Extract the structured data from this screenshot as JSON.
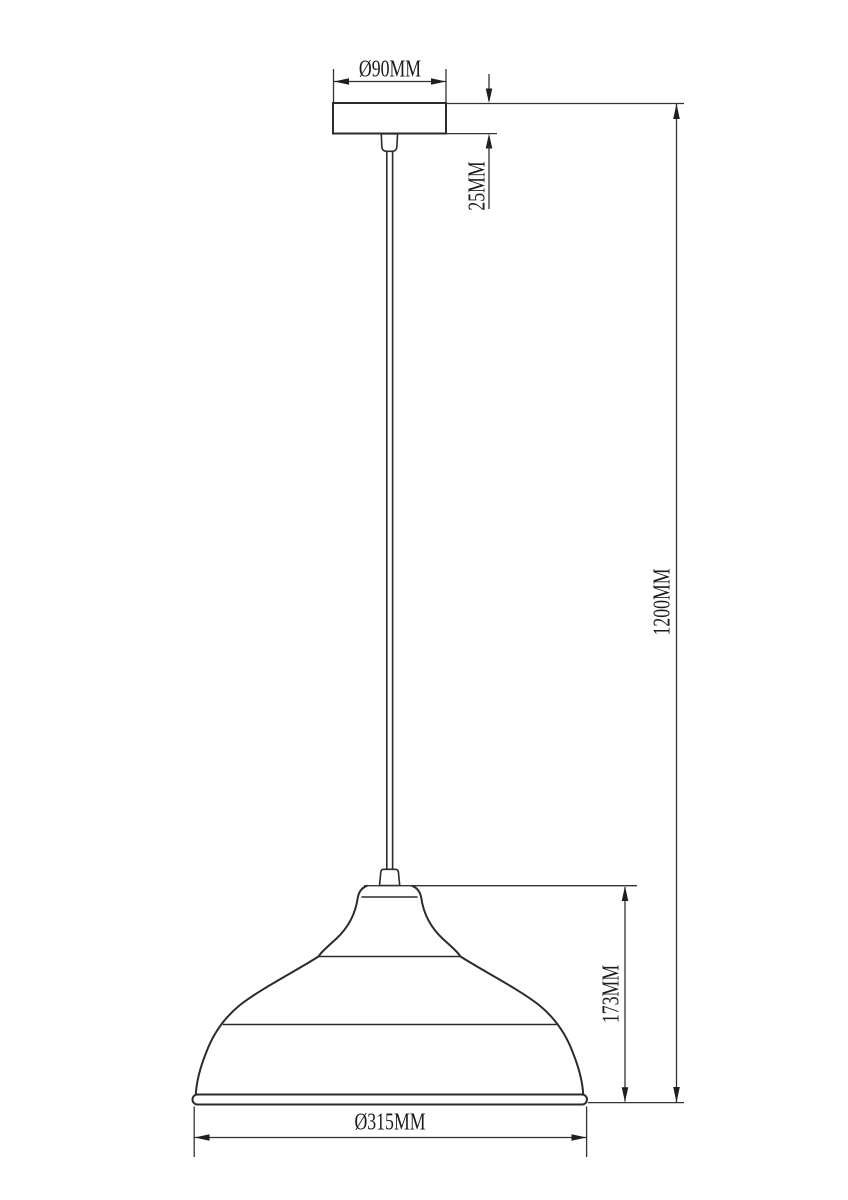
{
  "drawing": {
    "description": "Pendant lamp dimensional line drawing",
    "colors": {
      "background": "#ffffff",
      "line": "#2b2b2b",
      "text": "#1c1c1c"
    },
    "dimensions": {
      "canopy_diameter": {
        "label": "Ø90MM"
      },
      "canopy_height": {
        "label": "25MM"
      },
      "overall_height": {
        "label": "1200MM"
      },
      "shade_height": {
        "label": "173MM"
      },
      "shade_diameter": {
        "label": "Ø315MM"
      }
    }
  }
}
